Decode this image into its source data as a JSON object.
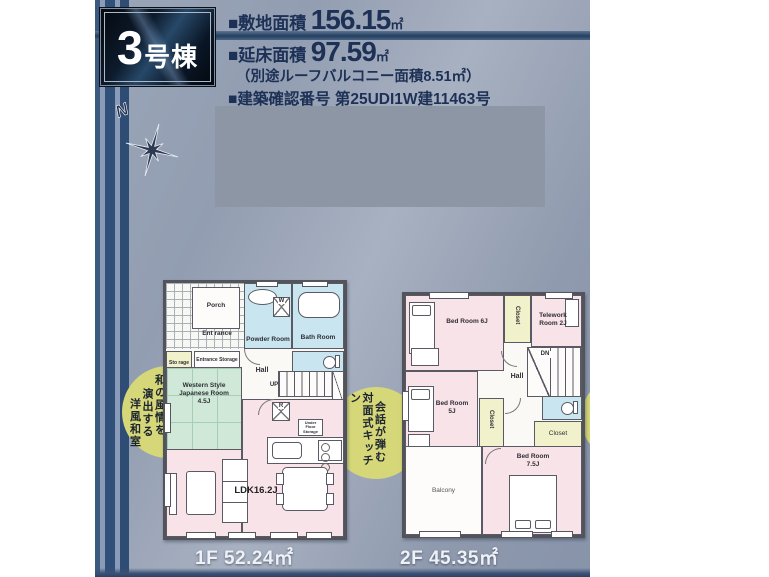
{
  "header": {
    "unit": {
      "number": "3",
      "suffix": "号棟"
    },
    "site_area": {
      "label": "■敷地面積",
      "value": "156.15",
      "unit": "㎡"
    },
    "floor_area": {
      "label": "■延床面積",
      "value": "97.59",
      "unit": "㎡"
    },
    "roof_note": "（別途ルーフバルコニー面積8.51㎡）",
    "cert": {
      "label": "■建築確認番号",
      "value": "第25UDI1W建11463号"
    },
    "cert_date": "（令和7年12月26日）"
  },
  "compass": {
    "north": "N"
  },
  "callouts": {
    "left_lines": [
      "和の風情を",
      "演出する",
      "洋風和室"
    ],
    "right_lines": [
      "会話が弾む",
      "対面式キッチン"
    ]
  },
  "floor1": {
    "area_label": "1F 52.24㎡",
    "rooms": {
      "porch": "Porch",
      "entrance": "Ent rance",
      "storage": "Sto rage",
      "entrance_storage": "Entrance Storage",
      "powder_room": "Powder Room",
      "bath_room": "Bath Room",
      "hall": "Hall",
      "up": "UP",
      "washer": "W",
      "fridge": "R",
      "under_floor_storage": "Under Floor Storage",
      "japanese_room": "Western Style Japanese Room 4.5J",
      "ldk": "LDK16.2J"
    }
  },
  "floor2": {
    "area_label": "2F 45.35㎡",
    "rooms": {
      "bed6": "Bed Room 6J",
      "closet1": "Closet",
      "telework": "Telework Room 2J",
      "dn": "DN",
      "hall": "Hall",
      "bed5": "Bed Room 5J",
      "closet2": "Closet",
      "closet3": "Closet",
      "balcony": "Balcony",
      "bed75": "Bed Room 7.5J"
    }
  },
  "colors": {
    "background": "#97a2b4",
    "accent_navy": "#1d3055",
    "room_pink": "#f8e3e9",
    "room_cyan": "#c9e6f0",
    "room_green": "#d0e8d8",
    "room_yellow": "#f1f2cb",
    "callout_yellow": "#d5d779"
  }
}
